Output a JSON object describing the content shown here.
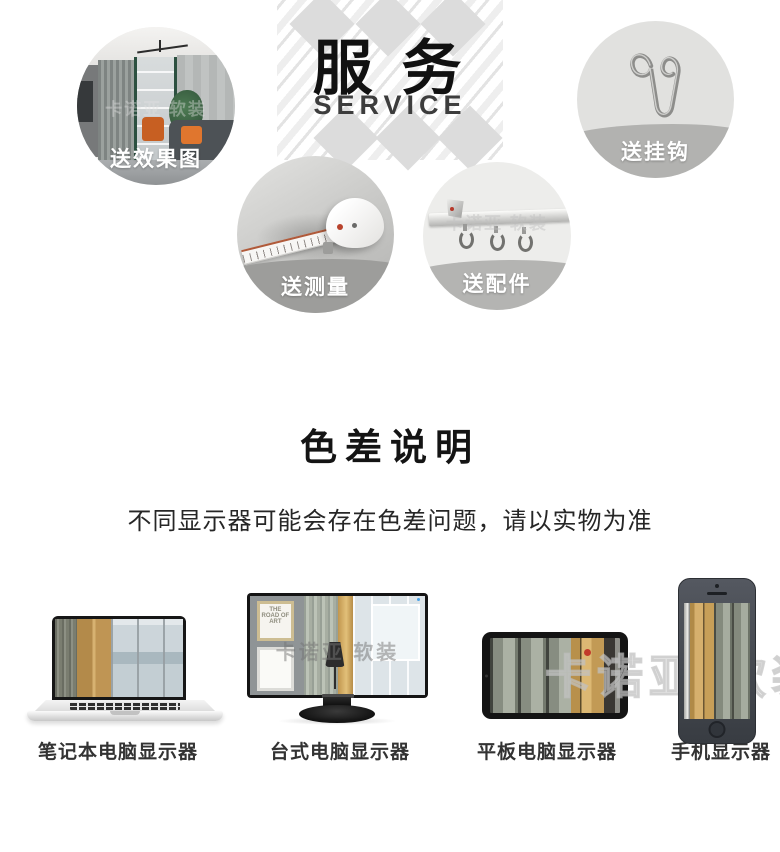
{
  "service": {
    "title": "服 务",
    "subtitle": "SERVICE",
    "items": [
      {
        "label": "送效果图"
      },
      {
        "label": "送挂钩"
      },
      {
        "label": "送测量"
      },
      {
        "label": "送配件"
      }
    ]
  },
  "color_note": {
    "title": "色差说明",
    "description": "不同显示器可能会存在色差问题，请以实物为准"
  },
  "devices": {
    "labels": [
      "笔记本电脑显示器",
      "台式电脑显示器",
      "平板电脑显示器",
      "手机显示器"
    ]
  },
  "watermark": {
    "text": "卡诺亚 软装"
  },
  "monitor": {
    "frame_text": "THE ROAD OF ART"
  },
  "colors": {
    "accent_gold": "#c6a05e",
    "fabric_gray": "#8d928a",
    "band_gray": "#b2b2b0",
    "red_dot": "#c23b2a",
    "heading_black": "#141414"
  }
}
